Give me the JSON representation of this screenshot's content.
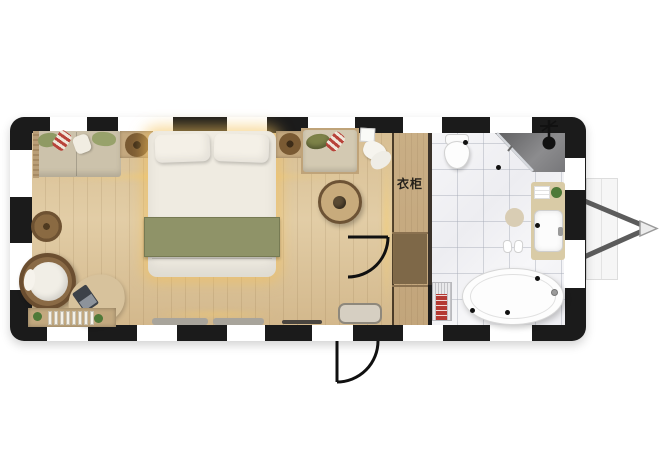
{
  "plan": {
    "type": "trailer-tiny-home-floor-plan",
    "labels": {
      "wardrobe": "衣柜"
    },
    "rooms": [
      {
        "name": "bedroom"
      },
      {
        "name": "wardrobe"
      },
      {
        "name": "bathroom"
      }
    ],
    "furniture": [
      "sofa-daybed",
      "double-bed",
      "nightstand",
      "round-tea-table",
      "bench-seat",
      "egg-chair",
      "pouf",
      "desk",
      "laptop",
      "bookshelf",
      "tv-console",
      "toilet",
      "shower",
      "vanity-sink",
      "bathtub",
      "towel-radiator",
      "trailer-hitch"
    ],
    "colors": {
      "wall": "#1b1b1b",
      "wood_floor": "#d8bf94",
      "marble_floor": "#f4f4f6",
      "bed_runner_green": "#8f9368",
      "glow_warm": "#f8cd69",
      "rattan_brown": "#7a5a36",
      "hitch_gray": "#5c5c5c"
    }
  }
}
